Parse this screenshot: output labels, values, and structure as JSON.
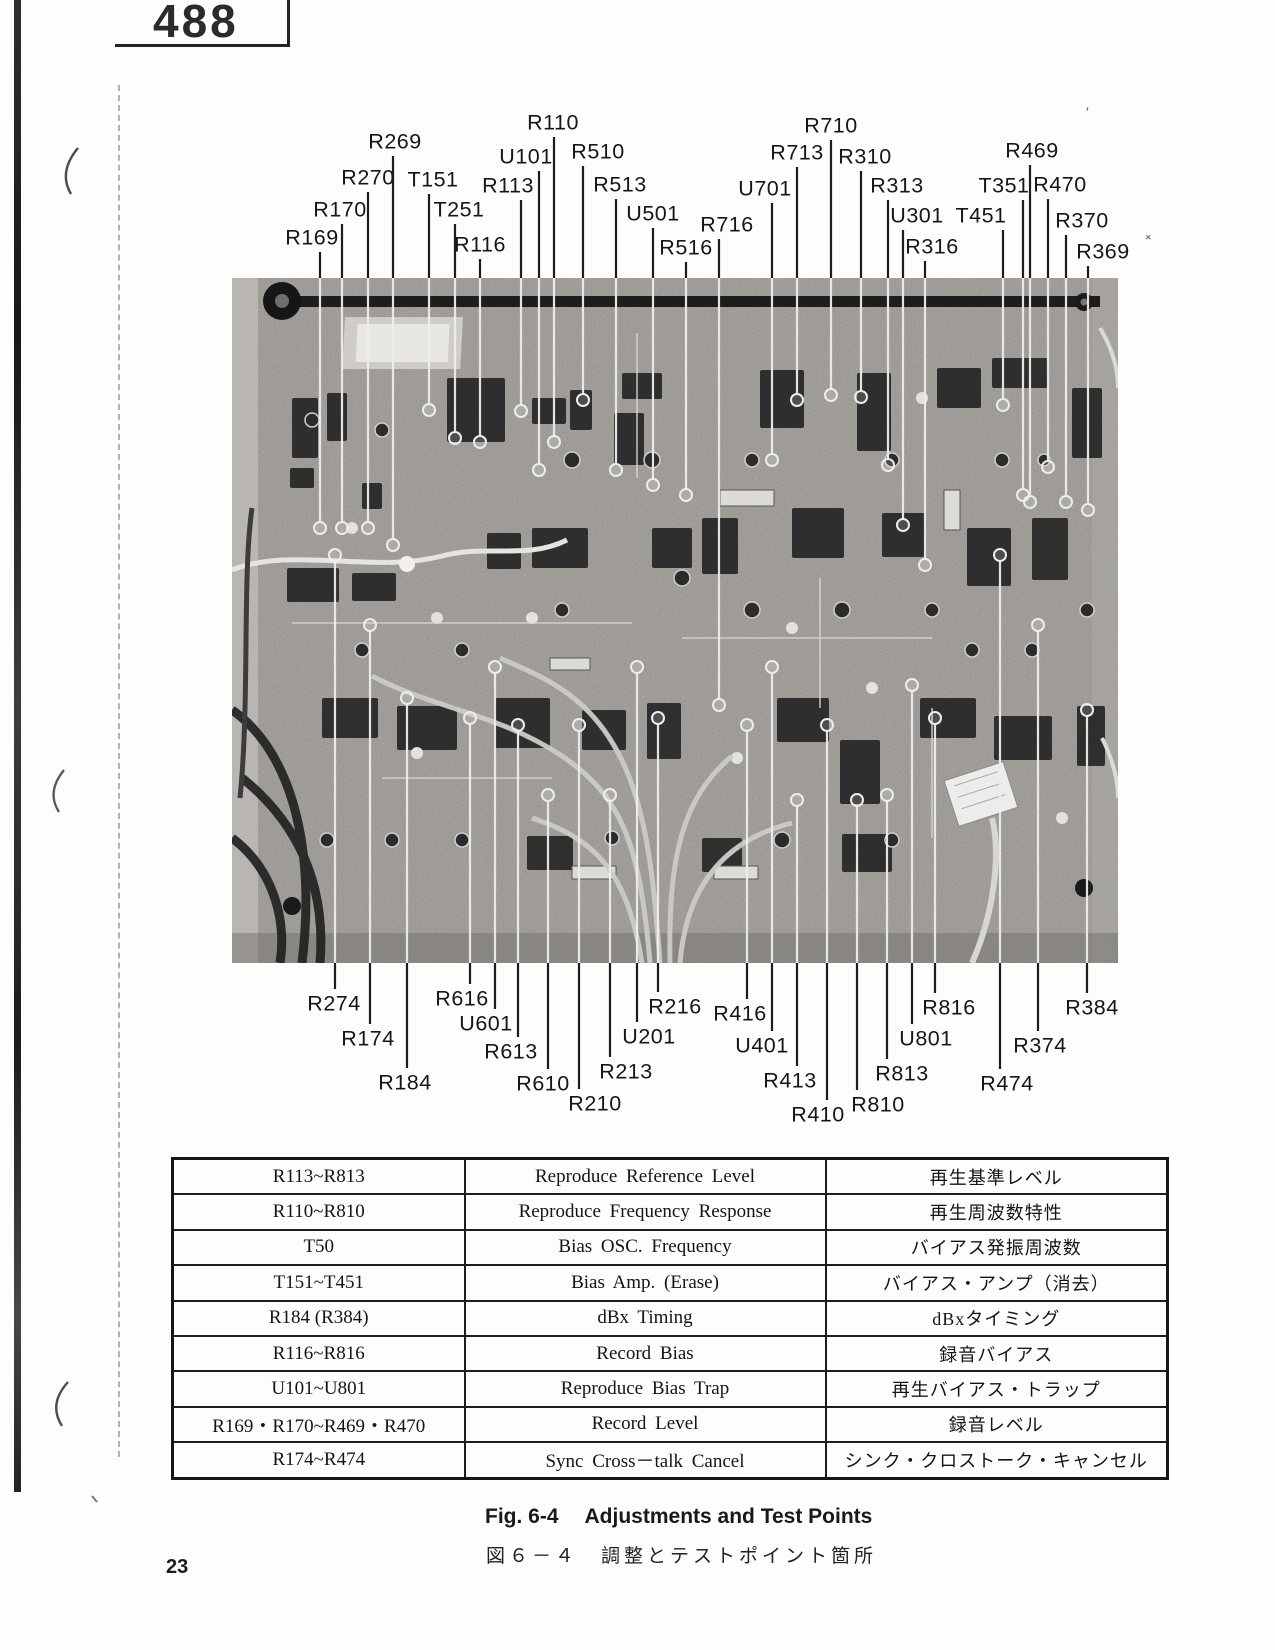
{
  "page": {
    "doc_number": "488",
    "page_number": "23"
  },
  "figure": {
    "caption": {
      "fig_label": "Fig. 6-4",
      "fig_title": "Adjustments and Test Points",
      "ja_label": "図６－４",
      "ja_title": "調整とテストポイント箇所"
    },
    "photo_alt": "Printed circuit board top view with adjustment trimmers and test points",
    "callouts": [
      {
        "label": "R169",
        "side": "top",
        "x": 312,
        "y": 238,
        "lx": 320,
        "ty": 523
      },
      {
        "label": "R170",
        "side": "top",
        "x": 340,
        "y": 210,
        "lx": 342,
        "ty": 523
      },
      {
        "label": "R270",
        "side": "top",
        "x": 368,
        "y": 178,
        "lx": 368,
        "ty": 523
      },
      {
        "label": "R269",
        "side": "top",
        "x": 395,
        "y": 142,
        "lx": 393,
        "ty": 540
      },
      {
        "label": "T151",
        "side": "top",
        "x": 433,
        "y": 180,
        "lx": 429,
        "ty": 405
      },
      {
        "label": "T251",
        "side": "top",
        "x": 459,
        "y": 210,
        "lx": 455,
        "ty": 433
      },
      {
        "label": "R116",
        "side": "top",
        "x": 480,
        "y": 245,
        "lx": 480,
        "ty": 437
      },
      {
        "label": "R113",
        "side": "top",
        "x": 508,
        "y": 186,
        "lx": 521,
        "ty": 406
      },
      {
        "label": "U101",
        "side": "top",
        "x": 526,
        "y": 157,
        "lx": 539,
        "ty": 465
      },
      {
        "label": "R110",
        "side": "top",
        "x": 553,
        "y": 123,
        "lx": 554,
        "ty": 437
      },
      {
        "label": "R510",
        "side": "top",
        "x": 598,
        "y": 152,
        "lx": 583,
        "ty": 395
      },
      {
        "label": "R513",
        "side": "top",
        "x": 620,
        "y": 185,
        "lx": 616,
        "ty": 465
      },
      {
        "label": "U501",
        "side": "top",
        "x": 653,
        "y": 214,
        "lx": 653,
        "ty": 480
      },
      {
        "label": "R516",
        "side": "top",
        "x": 686,
        "y": 248,
        "lx": 686,
        "ty": 490
      },
      {
        "label": "R716",
        "side": "top",
        "x": 727,
        "y": 225,
        "lx": 719,
        "ty": 700
      },
      {
        "label": "U701",
        "side": "top",
        "x": 765,
        "y": 189,
        "lx": 772,
        "ty": 455
      },
      {
        "label": "R713",
        "side": "top",
        "x": 797,
        "y": 153,
        "lx": 797,
        "ty": 395
      },
      {
        "label": "R710",
        "side": "top",
        "x": 831,
        "y": 126,
        "lx": 831,
        "ty": 390
      },
      {
        "label": "R310",
        "side": "top",
        "x": 865,
        "y": 157,
        "lx": 861,
        "ty": 392
      },
      {
        "label": "R313",
        "side": "top",
        "x": 897,
        "y": 186,
        "lx": 888,
        "ty": 460
      },
      {
        "label": "U301",
        "side": "top",
        "x": 917,
        "y": 216,
        "lx": 903,
        "ty": 520
      },
      {
        "label": "R316",
        "side": "top",
        "x": 932,
        "y": 247,
        "lx": 925,
        "ty": 560
      },
      {
        "label": "T451",
        "side": "top",
        "x": 981,
        "y": 216,
        "lx": 1003,
        "ty": 400
      },
      {
        "label": "T351",
        "side": "top",
        "x": 1004,
        "y": 186,
        "lx": 1023,
        "ty": 490
      },
      {
        "label": "R469",
        "side": "top",
        "x": 1032,
        "y": 151,
        "lx": 1030,
        "ty": 497
      },
      {
        "label": "R470",
        "side": "top",
        "x": 1060,
        "y": 185,
        "lx": 1048,
        "ty": 462
      },
      {
        "label": "R370",
        "side": "top",
        "x": 1082,
        "y": 221,
        "lx": 1066,
        "ty": 497
      },
      {
        "label": "R369",
        "side": "top",
        "x": 1103,
        "y": 252,
        "lx": 1088,
        "ty": 505
      },
      {
        "label": "R274",
        "side": "bottom",
        "x": 334,
        "y": 1004,
        "lx": 335,
        "ty": 560
      },
      {
        "label": "R174",
        "side": "bottom",
        "x": 368,
        "y": 1039,
        "lx": 370,
        "ty": 630
      },
      {
        "label": "R184",
        "side": "bottom",
        "x": 405,
        "y": 1083,
        "lx": 407,
        "ty": 703
      },
      {
        "label": "R616",
        "side": "bottom",
        "x": 462,
        "y": 999,
        "lx": 470,
        "ty": 723
      },
      {
        "label": "U601",
        "side": "bottom",
        "x": 486,
        "y": 1024,
        "lx": 495,
        "ty": 672
      },
      {
        "label": "R613",
        "side": "bottom",
        "x": 511,
        "y": 1052,
        "lx": 518,
        "ty": 730
      },
      {
        "label": "R610",
        "side": "bottom",
        "x": 543,
        "y": 1084,
        "lx": 548,
        "ty": 800
      },
      {
        "label": "R210",
        "side": "bottom",
        "x": 595,
        "y": 1104,
        "lx": 579,
        "ty": 730
      },
      {
        "label": "R213",
        "side": "bottom",
        "x": 626,
        "y": 1072,
        "lx": 610,
        "ty": 800
      },
      {
        "label": "U201",
        "side": "bottom",
        "x": 649,
        "y": 1037,
        "lx": 637,
        "ty": 672
      },
      {
        "label": "R216",
        "side": "bottom",
        "x": 675,
        "y": 1007,
        "lx": 658,
        "ty": 723
      },
      {
        "label": "R416",
        "side": "bottom",
        "x": 740,
        "y": 1014,
        "lx": 747,
        "ty": 730
      },
      {
        "label": "U401",
        "side": "bottom",
        "x": 762,
        "y": 1046,
        "lx": 772,
        "ty": 672
      },
      {
        "label": "R413",
        "side": "bottom",
        "x": 790,
        "y": 1081,
        "lx": 797,
        "ty": 805
      },
      {
        "label": "R410",
        "side": "bottom",
        "x": 818,
        "y": 1115,
        "lx": 827,
        "ty": 730
      },
      {
        "label": "R810",
        "side": "bottom",
        "x": 878,
        "y": 1105,
        "lx": 857,
        "ty": 805
      },
      {
        "label": "R813",
        "side": "bottom",
        "x": 902,
        "y": 1074,
        "lx": 887,
        "ty": 800
      },
      {
        "label": "U801",
        "side": "bottom",
        "x": 926,
        "y": 1039,
        "lx": 912,
        "ty": 690
      },
      {
        "label": "R816",
        "side": "bottom",
        "x": 949,
        "y": 1008,
        "lx": 935,
        "ty": 723
      },
      {
        "label": "R474",
        "side": "bottom",
        "x": 1007,
        "y": 1084,
        "lx": 1000,
        "ty": 560
      },
      {
        "label": "R374",
        "side": "bottom",
        "x": 1040,
        "y": 1046,
        "lx": 1038,
        "ty": 630
      },
      {
        "label": "R384",
        "side": "bottom",
        "x": 1092,
        "y": 1008,
        "lx": 1087,
        "ty": 715
      }
    ]
  },
  "table": {
    "rows": [
      {
        "ref": "R113~R813",
        "en": "Reproduce  Reference  Level",
        "ja": "再生基準レベル"
      },
      {
        "ref": "R110~R810",
        "en": "Reproduce  Frequency  Response",
        "ja": "再生周波数特性"
      },
      {
        "ref": "T50",
        "en": "Bias  OSC.  Frequency",
        "ja": "バイアス発振周波数"
      },
      {
        "ref": "T151~T451",
        "en": "Bias  Amp.  (Erase)",
        "ja": "バイアス・アンプ（消去）"
      },
      {
        "ref": "R184 (R384)",
        "en": "dBx  Timing",
        "ja": "dBxタイミング"
      },
      {
        "ref": "R116~R816",
        "en": "Record  Bias",
        "ja": "録音バイアス"
      },
      {
        "ref": "U101~U801",
        "en": "Reproduce  Bias  Trap",
        "ja": "再生バイアス・トラップ"
      },
      {
        "ref": "R169・R170~R469・R470",
        "en": "Record  Level",
        "ja": "録音レベル"
      },
      {
        "ref": "R174~R474",
        "en": "Sync  Cross－talk  Cancel",
        "ja": "シンク・クロストーク・キャンセル"
      }
    ]
  }
}
